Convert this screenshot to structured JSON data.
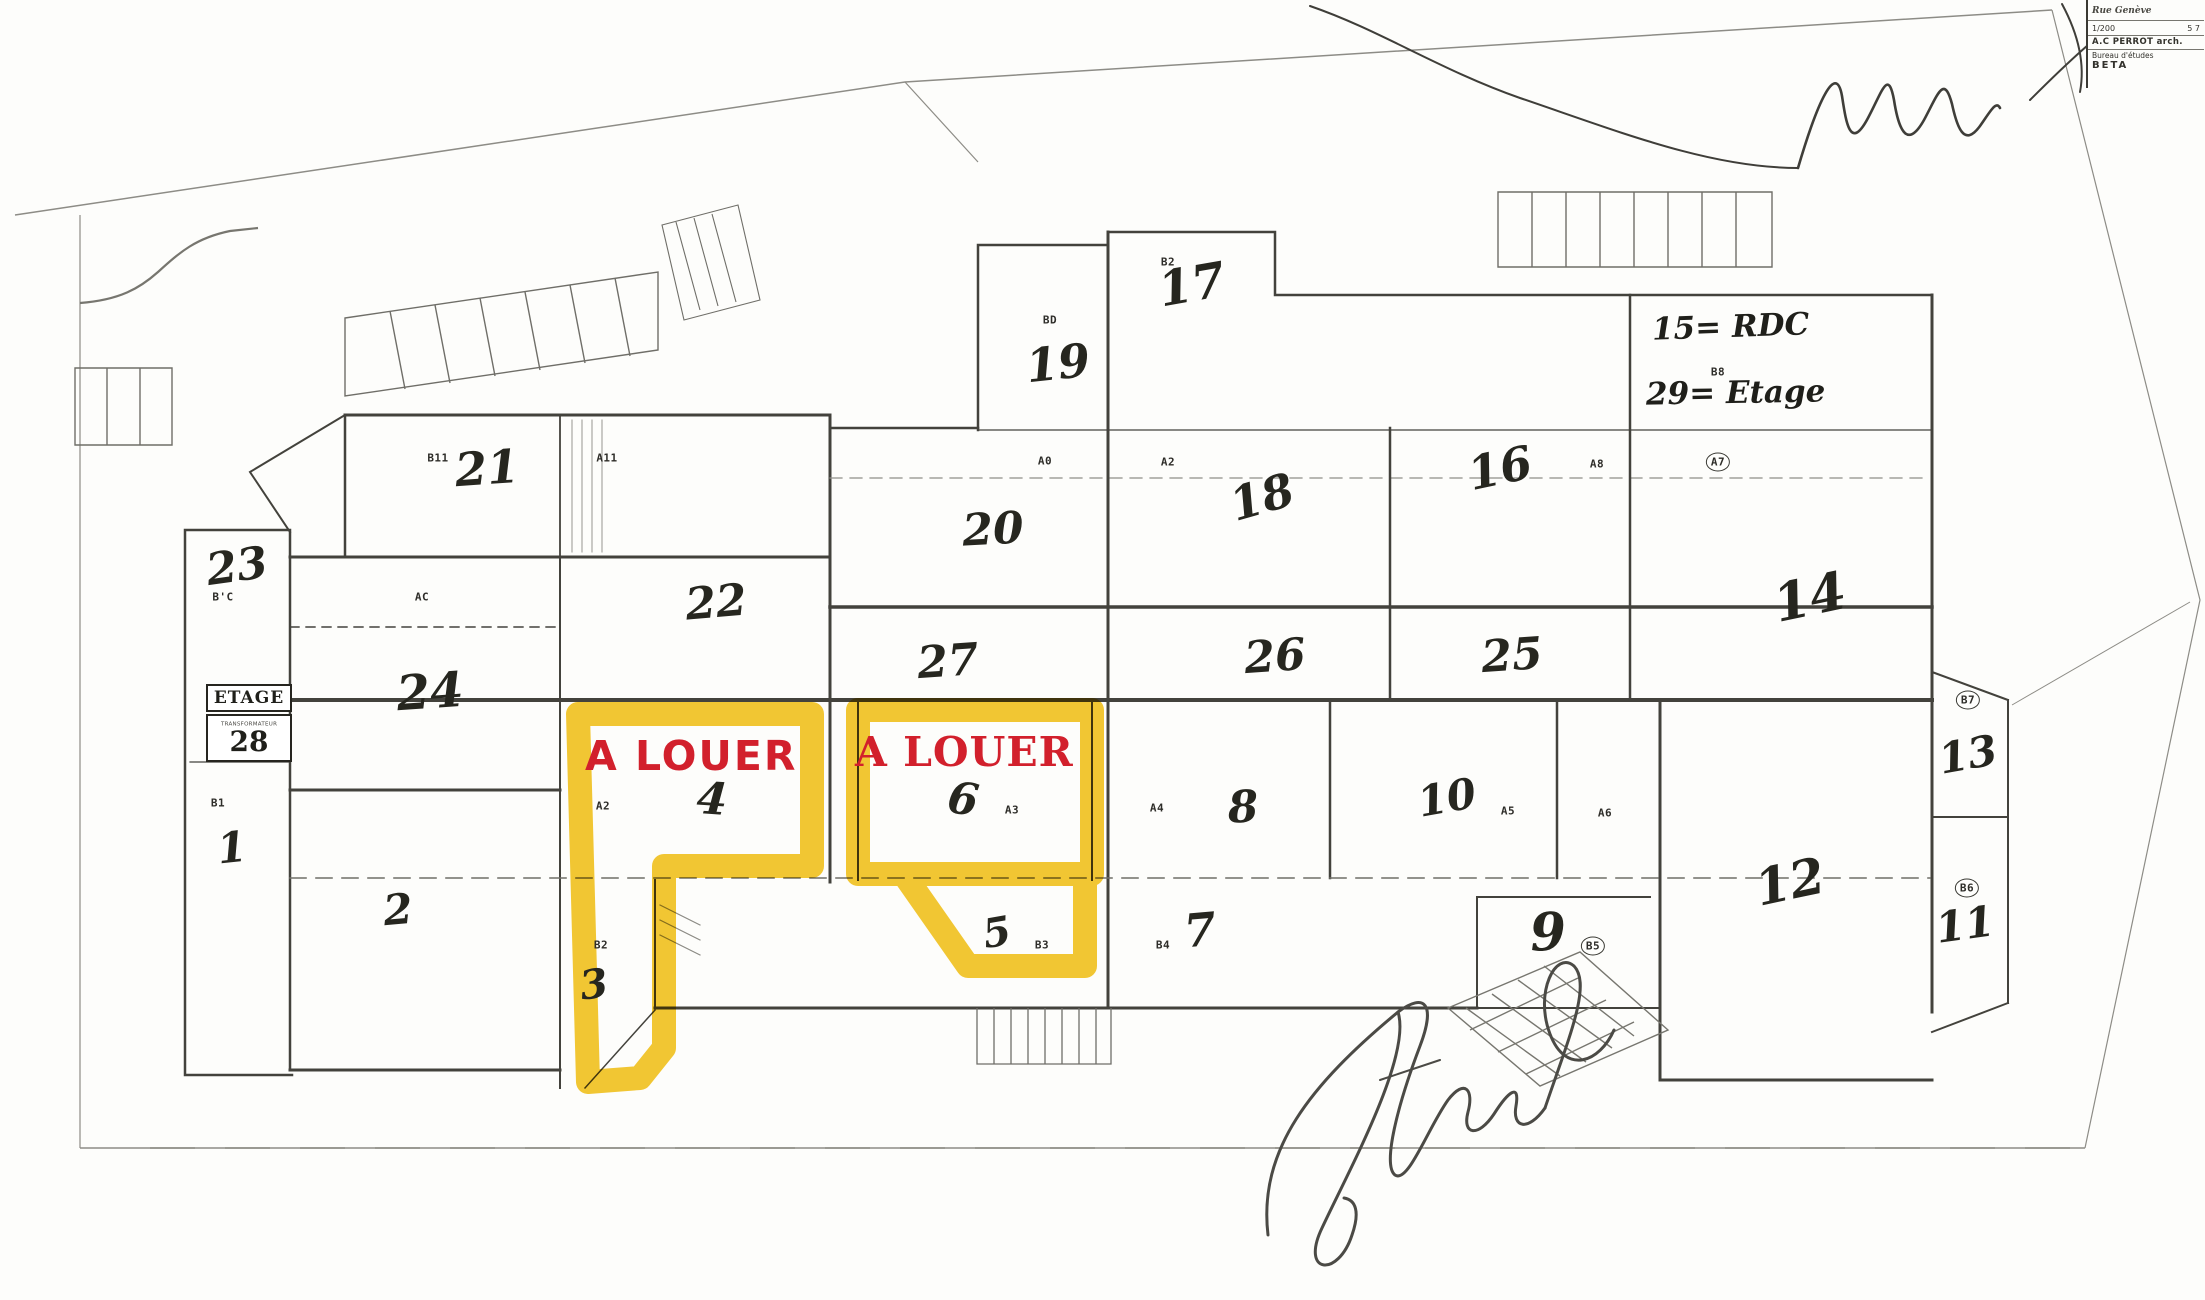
{
  "page": {
    "kind": "scanned commercial site plan",
    "background": "#fdfdfb"
  },
  "colors": {
    "highlight_yellow": "#f2c118",
    "alert_red": "#d2202c",
    "ink": "#26261f",
    "plan_line": "#43423c"
  },
  "title_block": {
    "project": "Rue Genève",
    "scale": "1/200",
    "sheet": "5 7",
    "architect": "A.C PERROT arch.",
    "office_label": "Bureau d'études",
    "office_name": "BETA"
  },
  "highlights": {
    "label_1": "A LOUER",
    "label_2": "A LOUER"
  },
  "notes": {
    "rdc": "15= RDC",
    "etage": "29= Etage",
    "etage_box": "ETAGE",
    "transformer": "TRANSFORMATEUR",
    "etage_box_number": "28"
  },
  "units": [
    {
      "label": "21",
      "x": 487,
      "y": 468,
      "size": 46,
      "rot": -4
    },
    {
      "label": "20",
      "x": 993,
      "y": 530,
      "size": 44,
      "rot": -3
    },
    {
      "label": "18",
      "x": 1262,
      "y": 497,
      "size": 46,
      "rot": -16
    },
    {
      "label": "16",
      "x": 1500,
      "y": 468,
      "size": 46,
      "rot": -12
    },
    {
      "label": "17",
      "x": 1192,
      "y": 285,
      "size": 48,
      "rot": -10
    },
    {
      "label": "19",
      "x": 1058,
      "y": 363,
      "size": 46,
      "rot": -6
    },
    {
      "label": "14",
      "x": 1810,
      "y": 598,
      "size": 52,
      "rot": -12
    },
    {
      "label": "22",
      "x": 716,
      "y": 603,
      "size": 44,
      "rot": -5
    },
    {
      "label": "27",
      "x": 948,
      "y": 662,
      "size": 44,
      "rot": -4
    },
    {
      "label": "26",
      "x": 1275,
      "y": 657,
      "size": 44,
      "rot": -4
    },
    {
      "label": "25",
      "x": 1512,
      "y": 656,
      "size": 44,
      "rot": -4
    },
    {
      "label": "24",
      "x": 430,
      "y": 692,
      "size": 48,
      "rot": -4
    },
    {
      "label": "23",
      "x": 237,
      "y": 567,
      "size": 44,
      "rot": -8
    },
    {
      "label": "4",
      "x": 712,
      "y": 800,
      "size": 44,
      "rot": 4
    },
    {
      "label": "6",
      "x": 963,
      "y": 800,
      "size": 44,
      "rot": 8
    },
    {
      "label": "8",
      "x": 1243,
      "y": 808,
      "size": 44,
      "rot": -3
    },
    {
      "label": "10",
      "x": 1447,
      "y": 798,
      "size": 42,
      "rot": -10
    },
    {
      "label": "12",
      "x": 1790,
      "y": 882,
      "size": 50,
      "rot": -12
    },
    {
      "label": "13",
      "x": 1968,
      "y": 755,
      "size": 42,
      "rot": -10
    },
    {
      "label": "11",
      "x": 1965,
      "y": 925,
      "size": 42,
      "rot": -8
    },
    {
      "label": "2",
      "x": 398,
      "y": 910,
      "size": 42,
      "rot": -5
    },
    {
      "label": "3",
      "x": 594,
      "y": 985,
      "size": 40,
      "rot": -8
    },
    {
      "label": "1",
      "x": 232,
      "y": 848,
      "size": 42,
      "rot": -6
    },
    {
      "label": "5",
      "x": 997,
      "y": 933,
      "size": 40,
      "rot": -10
    },
    {
      "label": "7",
      "x": 1200,
      "y": 930,
      "size": 46,
      "rot": -5
    },
    {
      "label": "9",
      "x": 1548,
      "y": 933,
      "size": 52,
      "rot": -3
    }
  ],
  "codes": [
    {
      "label": "B11",
      "x": 438,
      "y": 458
    },
    {
      "label": "A11",
      "x": 607,
      "y": 458
    },
    {
      "label": "A0",
      "x": 1045,
      "y": 461
    },
    {
      "label": "A2",
      "x": 1168,
      "y": 462
    },
    {
      "label": "A8",
      "x": 1597,
      "y": 464
    },
    {
      "label": "A7",
      "x": 1718,
      "y": 462,
      "circled": true
    },
    {
      "label": "BD",
      "x": 1050,
      "y": 320
    },
    {
      "label": "B2",
      "x": 1168,
      "y": 262
    },
    {
      "label": "B8",
      "x": 1718,
      "y": 372
    },
    {
      "label": "AC",
      "x": 422,
      "y": 597
    },
    {
      "label": "B'C",
      "x": 223,
      "y": 597
    },
    {
      "label": "A2",
      "x": 603,
      "y": 806
    },
    {
      "label": "A3",
      "x": 1012,
      "y": 810
    },
    {
      "label": "A4",
      "x": 1157,
      "y": 808
    },
    {
      "label": "A5",
      "x": 1508,
      "y": 811
    },
    {
      "label": "A6",
      "x": 1605,
      "y": 813
    },
    {
      "label": "B2",
      "x": 601,
      "y": 945
    },
    {
      "label": "B3",
      "x": 1042,
      "y": 945
    },
    {
      "label": "B4",
      "x": 1163,
      "y": 945
    },
    {
      "label": "B5",
      "x": 1593,
      "y": 946,
      "circled": true
    },
    {
      "label": "B6",
      "x": 1967,
      "y": 888,
      "circled": true
    },
    {
      "label": "B7",
      "x": 1968,
      "y": 700,
      "circled": true
    },
    {
      "label": "B1",
      "x": 218,
      "y": 803
    }
  ]
}
